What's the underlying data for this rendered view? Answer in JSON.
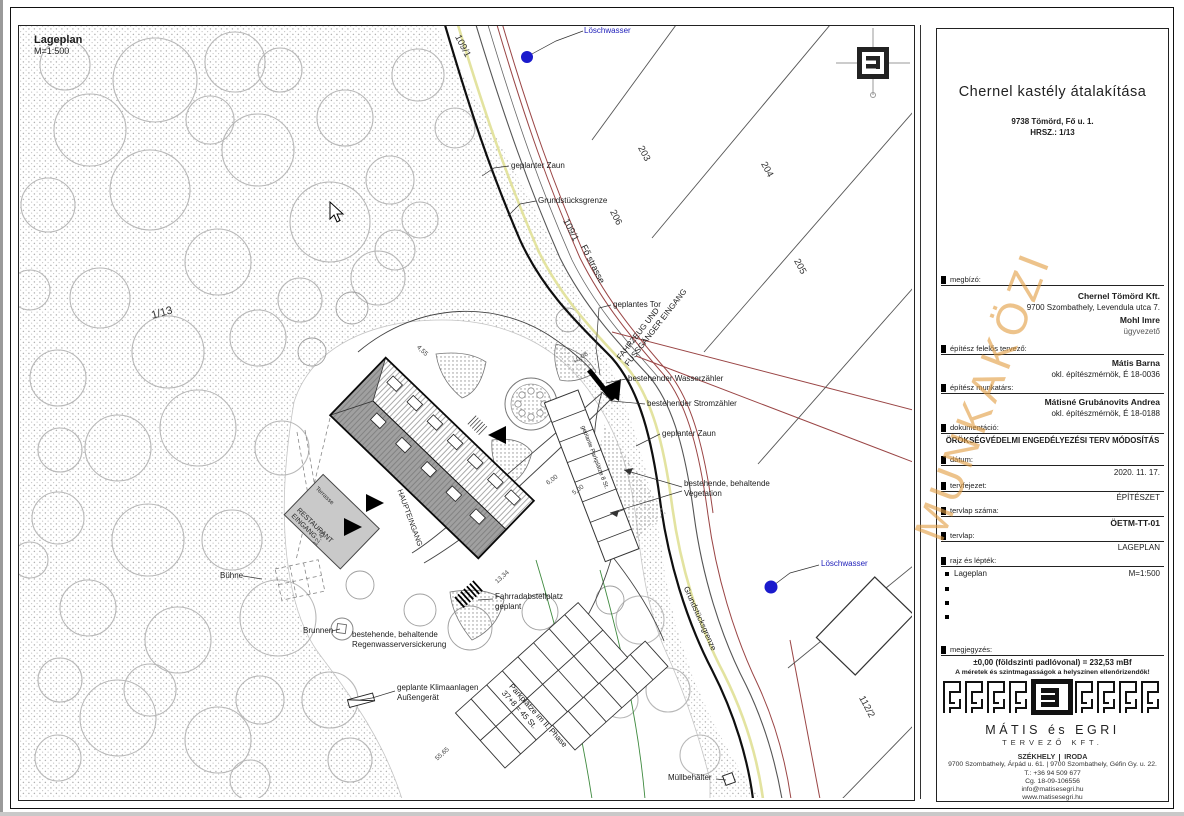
{
  "plan": {
    "corner_label": {
      "title": "Lageplan",
      "scale": "M=1:500"
    },
    "labels": {
      "loeschwasser_top": "Löschwasser",
      "geplanter_zaun_1": "geplanter Zaun",
      "grundstuecksgrenze_1": "Grundstücksgrenze",
      "geplantes_tor": "geplantes Tor",
      "fahrzeug_line1": "FAHRZEUG UND",
      "fahrzeug_line2": "FUSSGÄNGER EINGANG",
      "wasserzaehler": "bestehender Wasserzähler",
      "stromzaehler": "bestehender Stromzähler",
      "geplanter_zaun_2": "geplanter Zaun",
      "vegetation_line1": "bestehende, behaltende",
      "vegetation_line2": "Vegetation",
      "loeschwasser_bottom": "Löschwasser",
      "grundstuecksgrenze_2": "Grundstücksgrenze",
      "fo_strasse": "Fő strasse",
      "brunnen": "Brunnen",
      "buehne": "Bühne",
      "regenwasser_line1": "bestehende, behaltende",
      "regenwasser_line2": "Regenwasserversickerung",
      "fahrrad_line1": "Fahrradabstellplatz",
      "fahrrad_line2": "geplant",
      "klima_line1": "geplante Klimaanlagen",
      "klima_line2": "Außengerät",
      "muell": "Müllbehälter",
      "parkplaetze_1": "geplante Parkplätze 8 St.",
      "parkplaetze_2_line1": "Parkplätze im II. Phase",
      "parkplaetze_2_line2": "37+8 = 45 St.",
      "terrasse": "Terrasse",
      "restaurant_line1": "RESTAURANT",
      "restaurant_line2": "EINGANG",
      "haupteingang": "HAUPTEINGANG"
    },
    "parcels": {
      "p1_13": "1/13",
      "p109_1a": "109/1",
      "p109_1b": "109/1",
      "p203": "203",
      "p204": "204",
      "p205": "205",
      "p206": "206",
      "p112_2": "112/2"
    },
    "dims": {
      "d1": "4,55",
      "d2": "6,00",
      "d3": "5,00",
      "d4": "12,47",
      "d5": "13,34",
      "d6": "55,65",
      "d7": "+0,08"
    }
  },
  "watermark": "MUNKAKÖZI",
  "titleblock": {
    "project_title": "Chernel kastély átalakítása",
    "address_line1": "9738 Tömörd, Fő u. 1.",
    "address_line2": "HRSZ.: 1/13",
    "fields": {
      "megbizo_label": "megbízó:",
      "megbizo_1": "Chernel Tömörd Kft.",
      "megbizo_2": "9700 Szombathely, Levendula utca 7.",
      "megbizo_3": "Mohl Imre",
      "megbizo_4": "ügyvezető",
      "tervezo_label": "építész felelős tervező:",
      "tervezo_1": "Mátis Barna",
      "tervezo_2": "okl. építészmérnök, É 18-0036",
      "munkatars_label": "építész munkatárs:",
      "munkatars_1": "Mátisné Grubánovits Andrea",
      "munkatars_2": "okl. építészmérnök, É 18-0188",
      "dokumentacio_label": "dokumentáció:",
      "dokumentacio_value": "ÖRÖKSÉGVÉDELMI ENGEDÉLYEZÉSI TERV MÓDOSÍTÁS",
      "datum_label": "dátum:",
      "datum_value": "2020. 11. 17.",
      "tervfejezet_label": "tervfejezet:",
      "tervfejezet_value": "ÉPÍTÉSZET",
      "tervlap_szama_label": "tervlap száma:",
      "tervlap_szama_value": "ÖETM-TT-01",
      "tervlap_label": "tervlap:",
      "tervlap_value": "LAGEPLAN",
      "rajz_label": "rajz és lépték:",
      "rajz_item": "Lageplan",
      "rajz_scale": "M=1:500",
      "megjegyzes_label": "megjegyzés:",
      "megjegyzes_1": "±0,00 (földszinti padlóvonal) = 232,53 mBf",
      "megjegyzes_2": "A méretek és szintmagasságok a helyszínen ellenőrizendők!"
    },
    "company": {
      "name": "MÁTIS és EGRI",
      "type": "TERVEZŐ KFT.",
      "hq_label": "SZÉKHELY",
      "office_label": "IRODA",
      "address": "9700 Szombathely, Árpád u. 61.  |  9700 Szombathely, Géfin Gy. u. 22.",
      "phone": "T.: +36 94 509 677",
      "reg": "Cg. 18-09-106556",
      "email": "info@matisesegri.hu",
      "web": "www.matisesegri.hu"
    }
  },
  "colors": {
    "water_blue": "#1a1acc",
    "road_yellow": "#e3e3a0",
    "utility_red": "#9a4545",
    "vegetation_green": "#3f8a3f",
    "watermark_orange": "#e29e44"
  }
}
